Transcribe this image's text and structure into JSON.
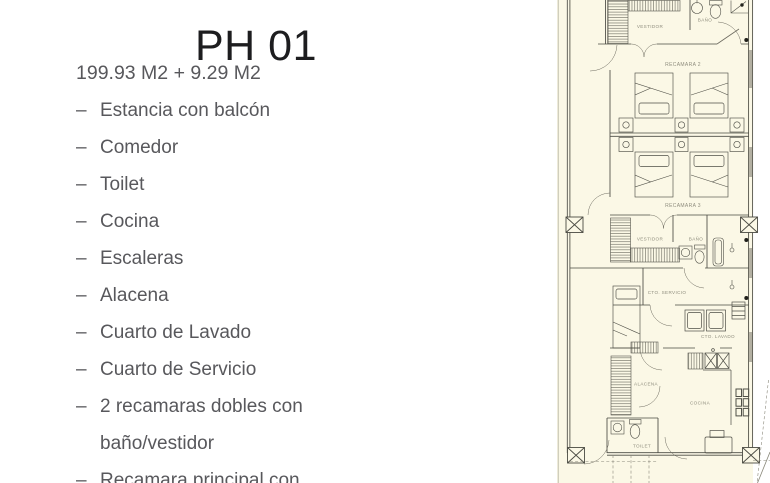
{
  "page": {
    "title": "PH 01",
    "area": "199.93 M2 + 9.29 M2",
    "bullet_char": "–",
    "features": [
      "Estancia con balcón",
      "Comedor",
      "Toilet",
      "Cocina",
      "Escaleras",
      "Alacena",
      "Cuarto de Lavado",
      "Cuarto de Servicio",
      "2 recamaras dobles con baño/vestidor",
      "Recamara principal con"
    ],
    "colors": {
      "title_text": "#1d1d1f",
      "body_text": "#58585c"
    }
  },
  "floorplan": {
    "labels": {
      "vestidor2": "VESTIDOR",
      "bano2": "BAÑO",
      "recamara2": "RECAMARA 2",
      "recamara3": "RECAMARA 3",
      "vestidor3": "VESTIDOR",
      "bano3": "BAÑO",
      "cto_servicio": "CTO. SERVICIO",
      "cto_lavado": "CTO. LAVADO",
      "alacena": "ALACENA",
      "cocina": "COCINA",
      "toilet": "TOILET"
    },
    "colors": {
      "paper": "#fbf8e6",
      "line": "#4b4b43",
      "label_text": "#8f8d7e",
      "window_fill": "#b3b0a2"
    }
  }
}
